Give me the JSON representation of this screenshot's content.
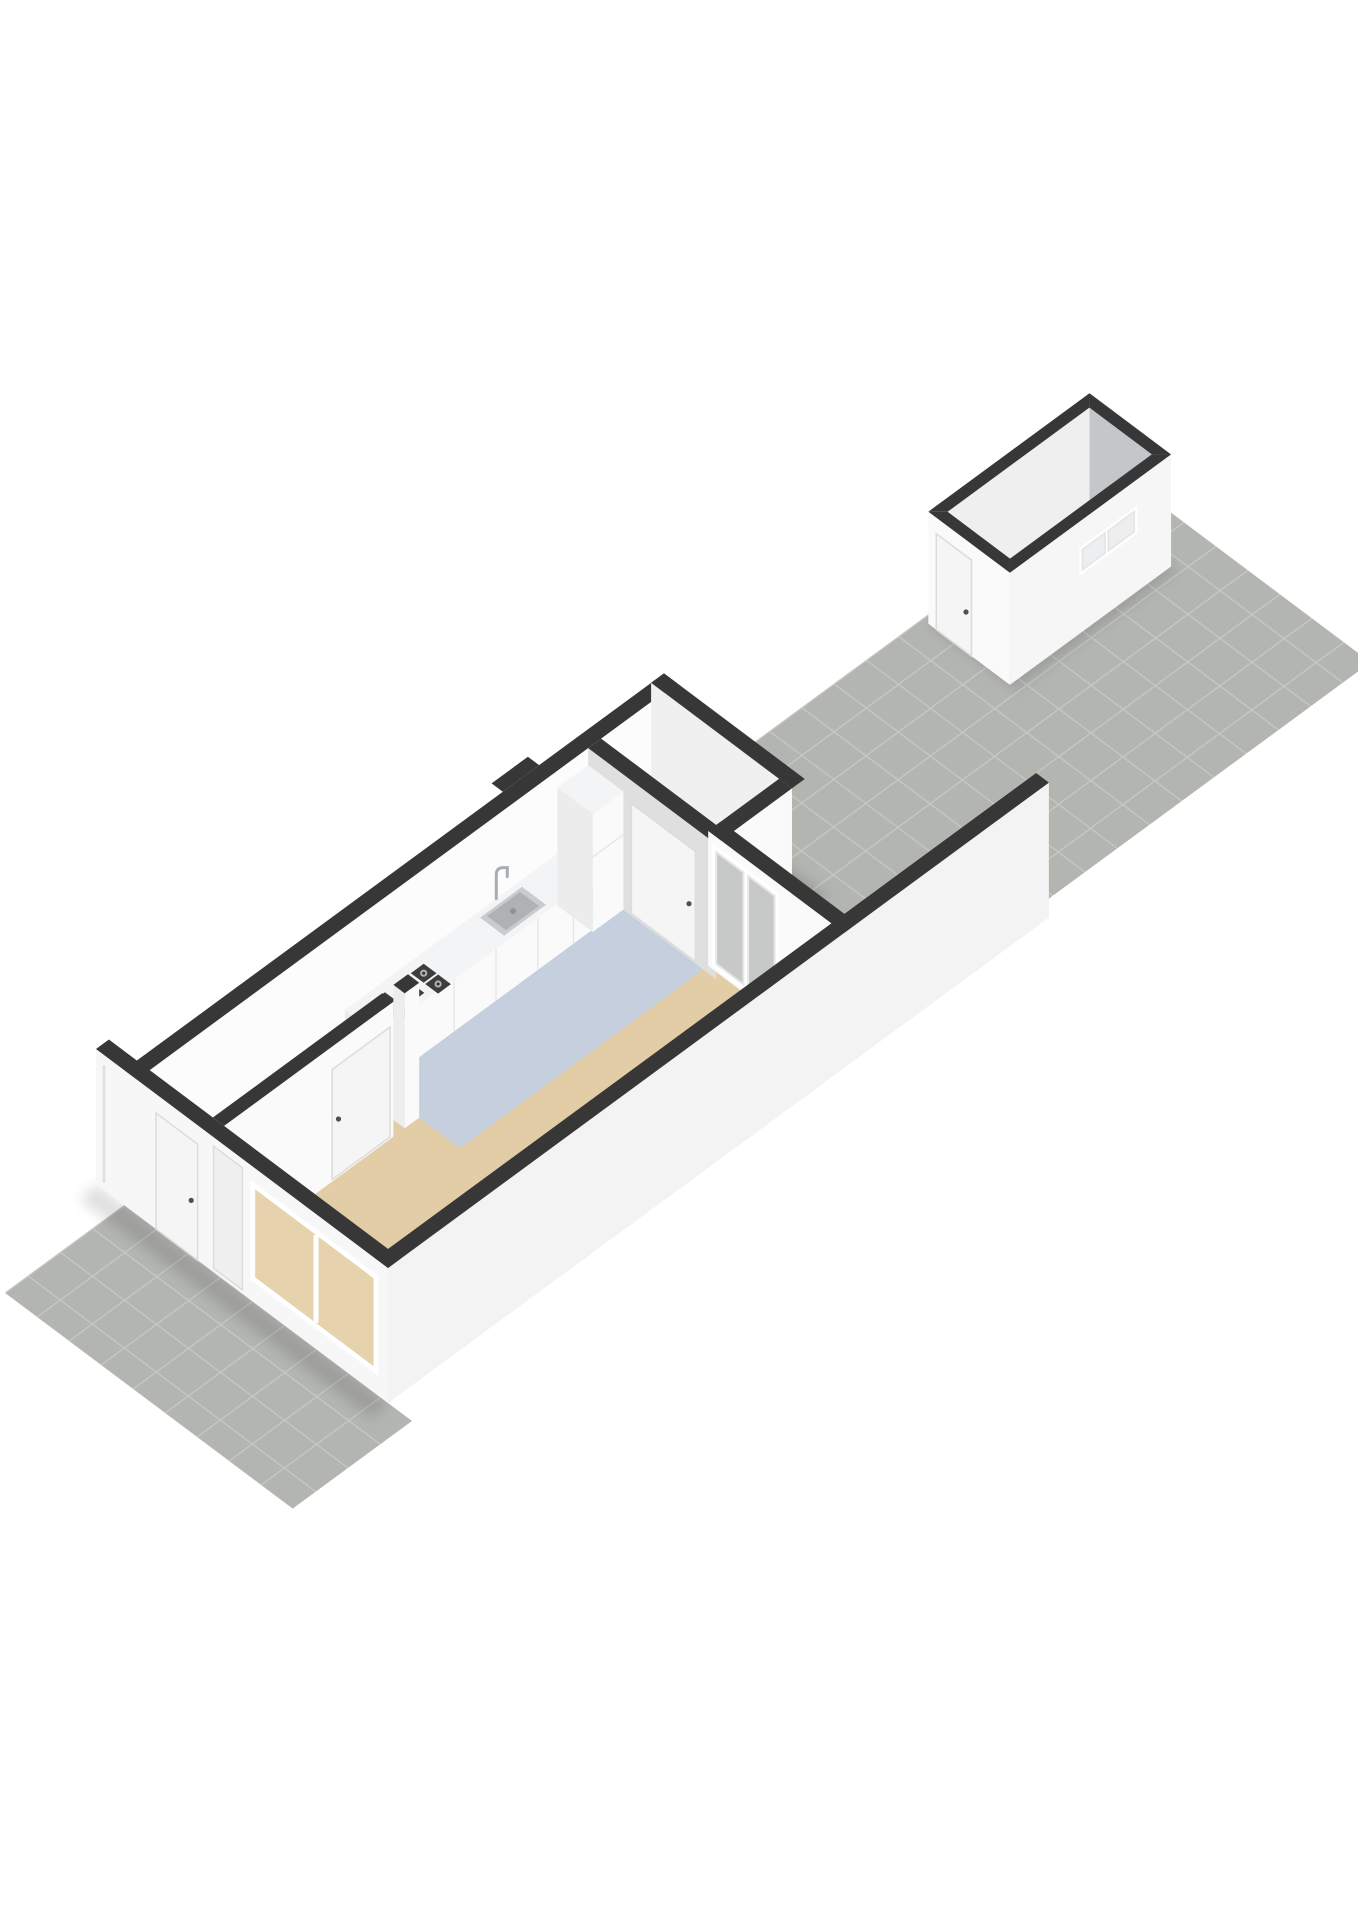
{
  "scene": {
    "type": "axonometric-3d-floorplan-render",
    "description": "3D cut-away floor plan of a narrow ground-floor dwelling with hallway, living room, open kitchen, storage closet, glazed back door to a paved courtyard garden, front paved path, and a detached storage shed at the rear",
    "rooms": [
      "hallway",
      "living-room",
      "kitchen",
      "storage-closet",
      "courtyard-garden",
      "front-path",
      "storage-shed"
    ],
    "fixtures": [
      "front-door",
      "front-window",
      "interior-door",
      "closet-door",
      "gas-hob",
      "kitchen-sink",
      "kitchen-faucet",
      "tall-cabinet",
      "back-door-glazed",
      "shed-door",
      "shed-window"
    ]
  },
  "colors": {
    "background": "#ffffff",
    "wall_cap": "#373737",
    "wall_white": "#fafafa",
    "wall_inner": "#fcfcfc",
    "wall_light": "#f0f0f0",
    "wall_gray": "#dfdfdf",
    "wall_side": "#ededed",
    "wall_se": "#f3f3f3",
    "wall_sw": "#f7f7f7",
    "floor_hall": "#f1f1f1",
    "floor_living": "#e3cda6",
    "floor_kitchen": "#c5cfde",
    "closet_floor": "#cfcfcf",
    "paving_tile": "#b3b5b1",
    "paving_grout": "#c8cac6",
    "shed_floor": "#d2d4d4",
    "shed_inner_nw": "#efefef",
    "shed_inner_ne": "#c4c7c9",
    "shed_face_sw": "#fafafa",
    "shed_face_se": "#f6f6f6",
    "counter_top": "#f3f4f6",
    "cabinet_front": "#fafafa",
    "cabinet_side": "#ececec",
    "grate": "#3d3d3d",
    "burner": "#b0b0b0",
    "burner_center": "#2e2e2e",
    "sink_rim": "#c9ccce",
    "sink_basin": "#aeb2b5",
    "sink_drain": "#8e9294",
    "faucet": "#a7adb1",
    "glass_courtyard": "#c6c9c7",
    "glass_window": "#e6d3ad",
    "glass_shed": "#eceeef",
    "frame": "#ffffff",
    "door_leaf": "#f5f5f5",
    "panel": "#f0f0f0",
    "handle": "#4f4f4f",
    "seam": "#e4e4e4",
    "downpipe": "#e2e2e2",
    "shadow": "rgba(20,20,20,0.12)"
  }
}
